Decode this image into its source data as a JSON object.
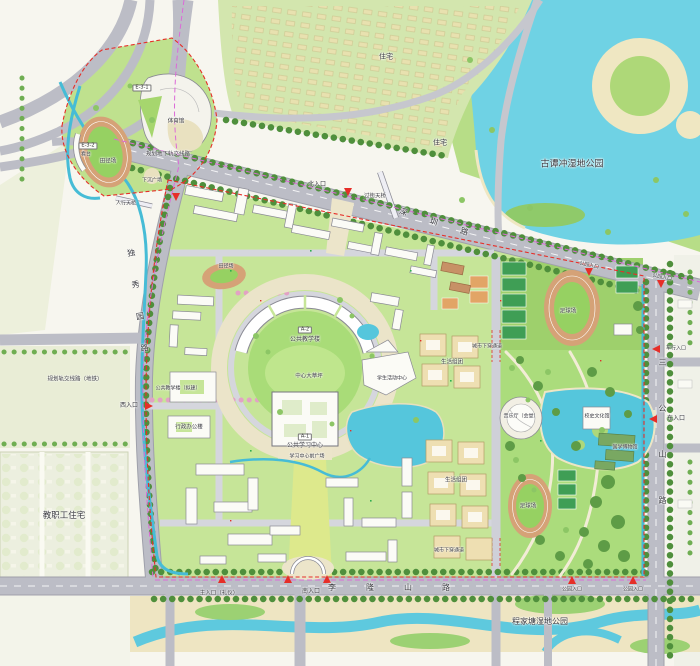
{
  "map_labels": {
    "roads": [
      {
        "name": "road-label-shenzhen",
        "text": "深圳路",
        "x": 445,
        "y": 226,
        "fs": 8,
        "ls": 24,
        "rot": 18
      },
      {
        "name": "road-label-duxiuyuan",
        "text": "独秀园路",
        "x": 139,
        "y": 312,
        "fs": 8,
        "ls": 24,
        "vert": true,
        "rot": -8
      },
      {
        "name": "road-label-sangongshan",
        "text": "三公山路",
        "x": 662,
        "y": 450,
        "fs": 8,
        "ls": 38,
        "vert": true
      },
      {
        "name": "road-label-lilongshan",
        "text": "李隆山路",
        "x": 404,
        "y": 588,
        "fs": 8,
        "ls": 30
      }
    ],
    "parks": [
      {
        "name": "park-label-gutanchong",
        "text": "古谭冲湿地公园",
        "x": 572,
        "y": 165,
        "fs": 9
      },
      {
        "name": "park-label-south-wetland",
        "text": "程家塘湿地公园",
        "x": 540,
        "y": 622,
        "fs": 8
      }
    ],
    "areas": [
      {
        "name": "area-label-residence-1",
        "text": "住宅",
        "x": 386,
        "y": 57,
        "fs": 7
      },
      {
        "name": "area-label-residence-2",
        "text": "住宅",
        "x": 440,
        "y": 143,
        "fs": 7
      },
      {
        "name": "area-label-faculty-housing",
        "text": "教职工住宅",
        "x": 64,
        "y": 516,
        "fs": 8.5
      },
      {
        "name": "area-label-central-lawn",
        "text": "中心大草坪",
        "x": 309,
        "y": 377,
        "fs": 5.5
      },
      {
        "name": "area-label-living-cluster-1",
        "text": "生活组团",
        "x": 452,
        "y": 363,
        "fs": 5.5
      },
      {
        "name": "area-label-living-cluster-2",
        "text": "生活组团",
        "x": 456,
        "y": 481,
        "fs": 5.5
      },
      {
        "name": "area-label-learning-plaza",
        "text": "学习中心前广场",
        "x": 307,
        "y": 457,
        "fs": 5
      }
    ],
    "buildings": [
      {
        "name": "building-tag-e31",
        "text": "E-3-1",
        "x": 142,
        "y": 88,
        "tag": true
      },
      {
        "name": "building-label-gymnasium",
        "text": "体育馆",
        "x": 176,
        "y": 122,
        "fs": 5.5
      },
      {
        "name": "building-tag-e32",
        "text": "E-3-2",
        "x": 88,
        "y": 146,
        "tag": true
      },
      {
        "name": "building-label-stands",
        "text": "看台",
        "x": 86,
        "y": 155,
        "fs": 5
      },
      {
        "name": "field-label-track-nw",
        "text": "田径场",
        "x": 108,
        "y": 162,
        "fs": 5.5
      },
      {
        "name": "field-label-track-west",
        "text": "田径场",
        "x": 226,
        "y": 267,
        "fs": 5
      },
      {
        "name": "field-label-soccer-ne",
        "text": "足球场",
        "x": 568,
        "y": 312,
        "fs": 5.5
      },
      {
        "name": "field-label-soccer-south",
        "text": "足球场",
        "x": 528,
        "y": 507,
        "fs": 5.5
      },
      {
        "name": "building-tag-a2",
        "text": "A-2",
        "x": 305,
        "y": 330,
        "tag": true
      },
      {
        "name": "building-label-public-teaching",
        "text": "公共教学楼",
        "x": 305,
        "y": 340,
        "fs": 6
      },
      {
        "name": "building-tag-a1",
        "text": "A-1",
        "x": 305,
        "y": 437,
        "tag": true
      },
      {
        "name": "building-label-learning-center",
        "text": "公共学习中心",
        "x": 305,
        "y": 446,
        "fs": 6
      },
      {
        "name": "building-label-teaching-planned",
        "text": "公共教学楼（拟建）",
        "x": 178,
        "y": 389,
        "fs": 5
      },
      {
        "name": "building-label-admin",
        "text": "行政办公楼",
        "x": 189,
        "y": 428,
        "fs": 5.5
      },
      {
        "name": "building-label-student-center",
        "text": "学生活动中心",
        "x": 392,
        "y": 379,
        "fs": 5
      },
      {
        "name": "building-label-concert-hall",
        "text": "音乐厅（会堂）",
        "x": 521,
        "y": 417,
        "fs": 5
      },
      {
        "name": "building-label-history-hall",
        "text": "校史文化馆",
        "x": 597,
        "y": 417,
        "fs": 5
      },
      {
        "name": "building-label-museum",
        "text": "国学博物馆",
        "x": 625,
        "y": 448,
        "fs": 5
      }
    ],
    "entrances": [
      {
        "name": "entrance-label-north",
        "text": "北入口",
        "x": 317,
        "y": 185,
        "fs": 6
      },
      {
        "name": "entrance-label-west",
        "text": "西入口",
        "x": 129,
        "y": 406,
        "fs": 6
      },
      {
        "name": "entrance-label-east",
        "text": "东入口",
        "x": 676,
        "y": 419,
        "fs": 6
      },
      {
        "name": "entrance-label-vehicle",
        "text": "车行入口",
        "x": 676,
        "y": 349,
        "fs": 5
      },
      {
        "name": "entrance-label-south",
        "text": "南入口",
        "x": 311,
        "y": 592,
        "fs": 6
      },
      {
        "name": "entrance-label-main",
        "text": "主入口（礼仪）",
        "x": 219,
        "y": 594,
        "fs": 5.5
      },
      {
        "name": "entrance-label-park-1",
        "text": "公园入口",
        "x": 589,
        "y": 266,
        "fs": 5,
        "rot": 12
      },
      {
        "name": "entrance-label-park-2",
        "text": "公园入口",
        "x": 662,
        "y": 278,
        "fs": 5,
        "rot": 12
      },
      {
        "name": "entrance-label-park-3",
        "text": "公园入口",
        "x": 572,
        "y": 590,
        "fs": 5
      },
      {
        "name": "entrance-label-park-4",
        "text": "公园入口",
        "x": 633,
        "y": 590,
        "fs": 5
      }
    ],
    "notes": [
      {
        "name": "note-metro-underground",
        "text": "规划地下轨交线路",
        "x": 168,
        "y": 155,
        "fs": 5.5
      },
      {
        "name": "note-metro-line-west",
        "text": "规划轨交线路（地铁）",
        "x": 75,
        "y": 380,
        "fs": 5.5
      },
      {
        "name": "note-underpass-north",
        "text": "城市下穿通道",
        "x": 487,
        "y": 347,
        "fs": 5
      },
      {
        "name": "note-underpass-south",
        "text": "城市下穿通道",
        "x": 449,
        "y": 551,
        "fs": 5
      },
      {
        "name": "note-crossing-bridge",
        "text": "过街天桥",
        "x": 375,
        "y": 197,
        "fs": 5.5
      },
      {
        "name": "note-pedestrian-bridge",
        "text": "人行天桥",
        "x": 126,
        "y": 204,
        "fs": 5
      },
      {
        "name": "note-sunken-plaza",
        "text": "下沉广场",
        "x": 152,
        "y": 181,
        "fs": 5
      }
    ]
  },
  "colors": {
    "water": "#5ac6dc",
    "lake": "#6fd2e4",
    "campus_green": "#c6e598",
    "park_green": "#aadc7c",
    "road": "#bcbdc6",
    "plaza": "#ece5ca",
    "track": "#d5a277",
    "field": "#96d162",
    "boundary_red": "#e62e28",
    "metro_magenta": "#dc6ad8",
    "building_white": "#fbfbf6",
    "dorm_beige": "#eedfb2"
  }
}
